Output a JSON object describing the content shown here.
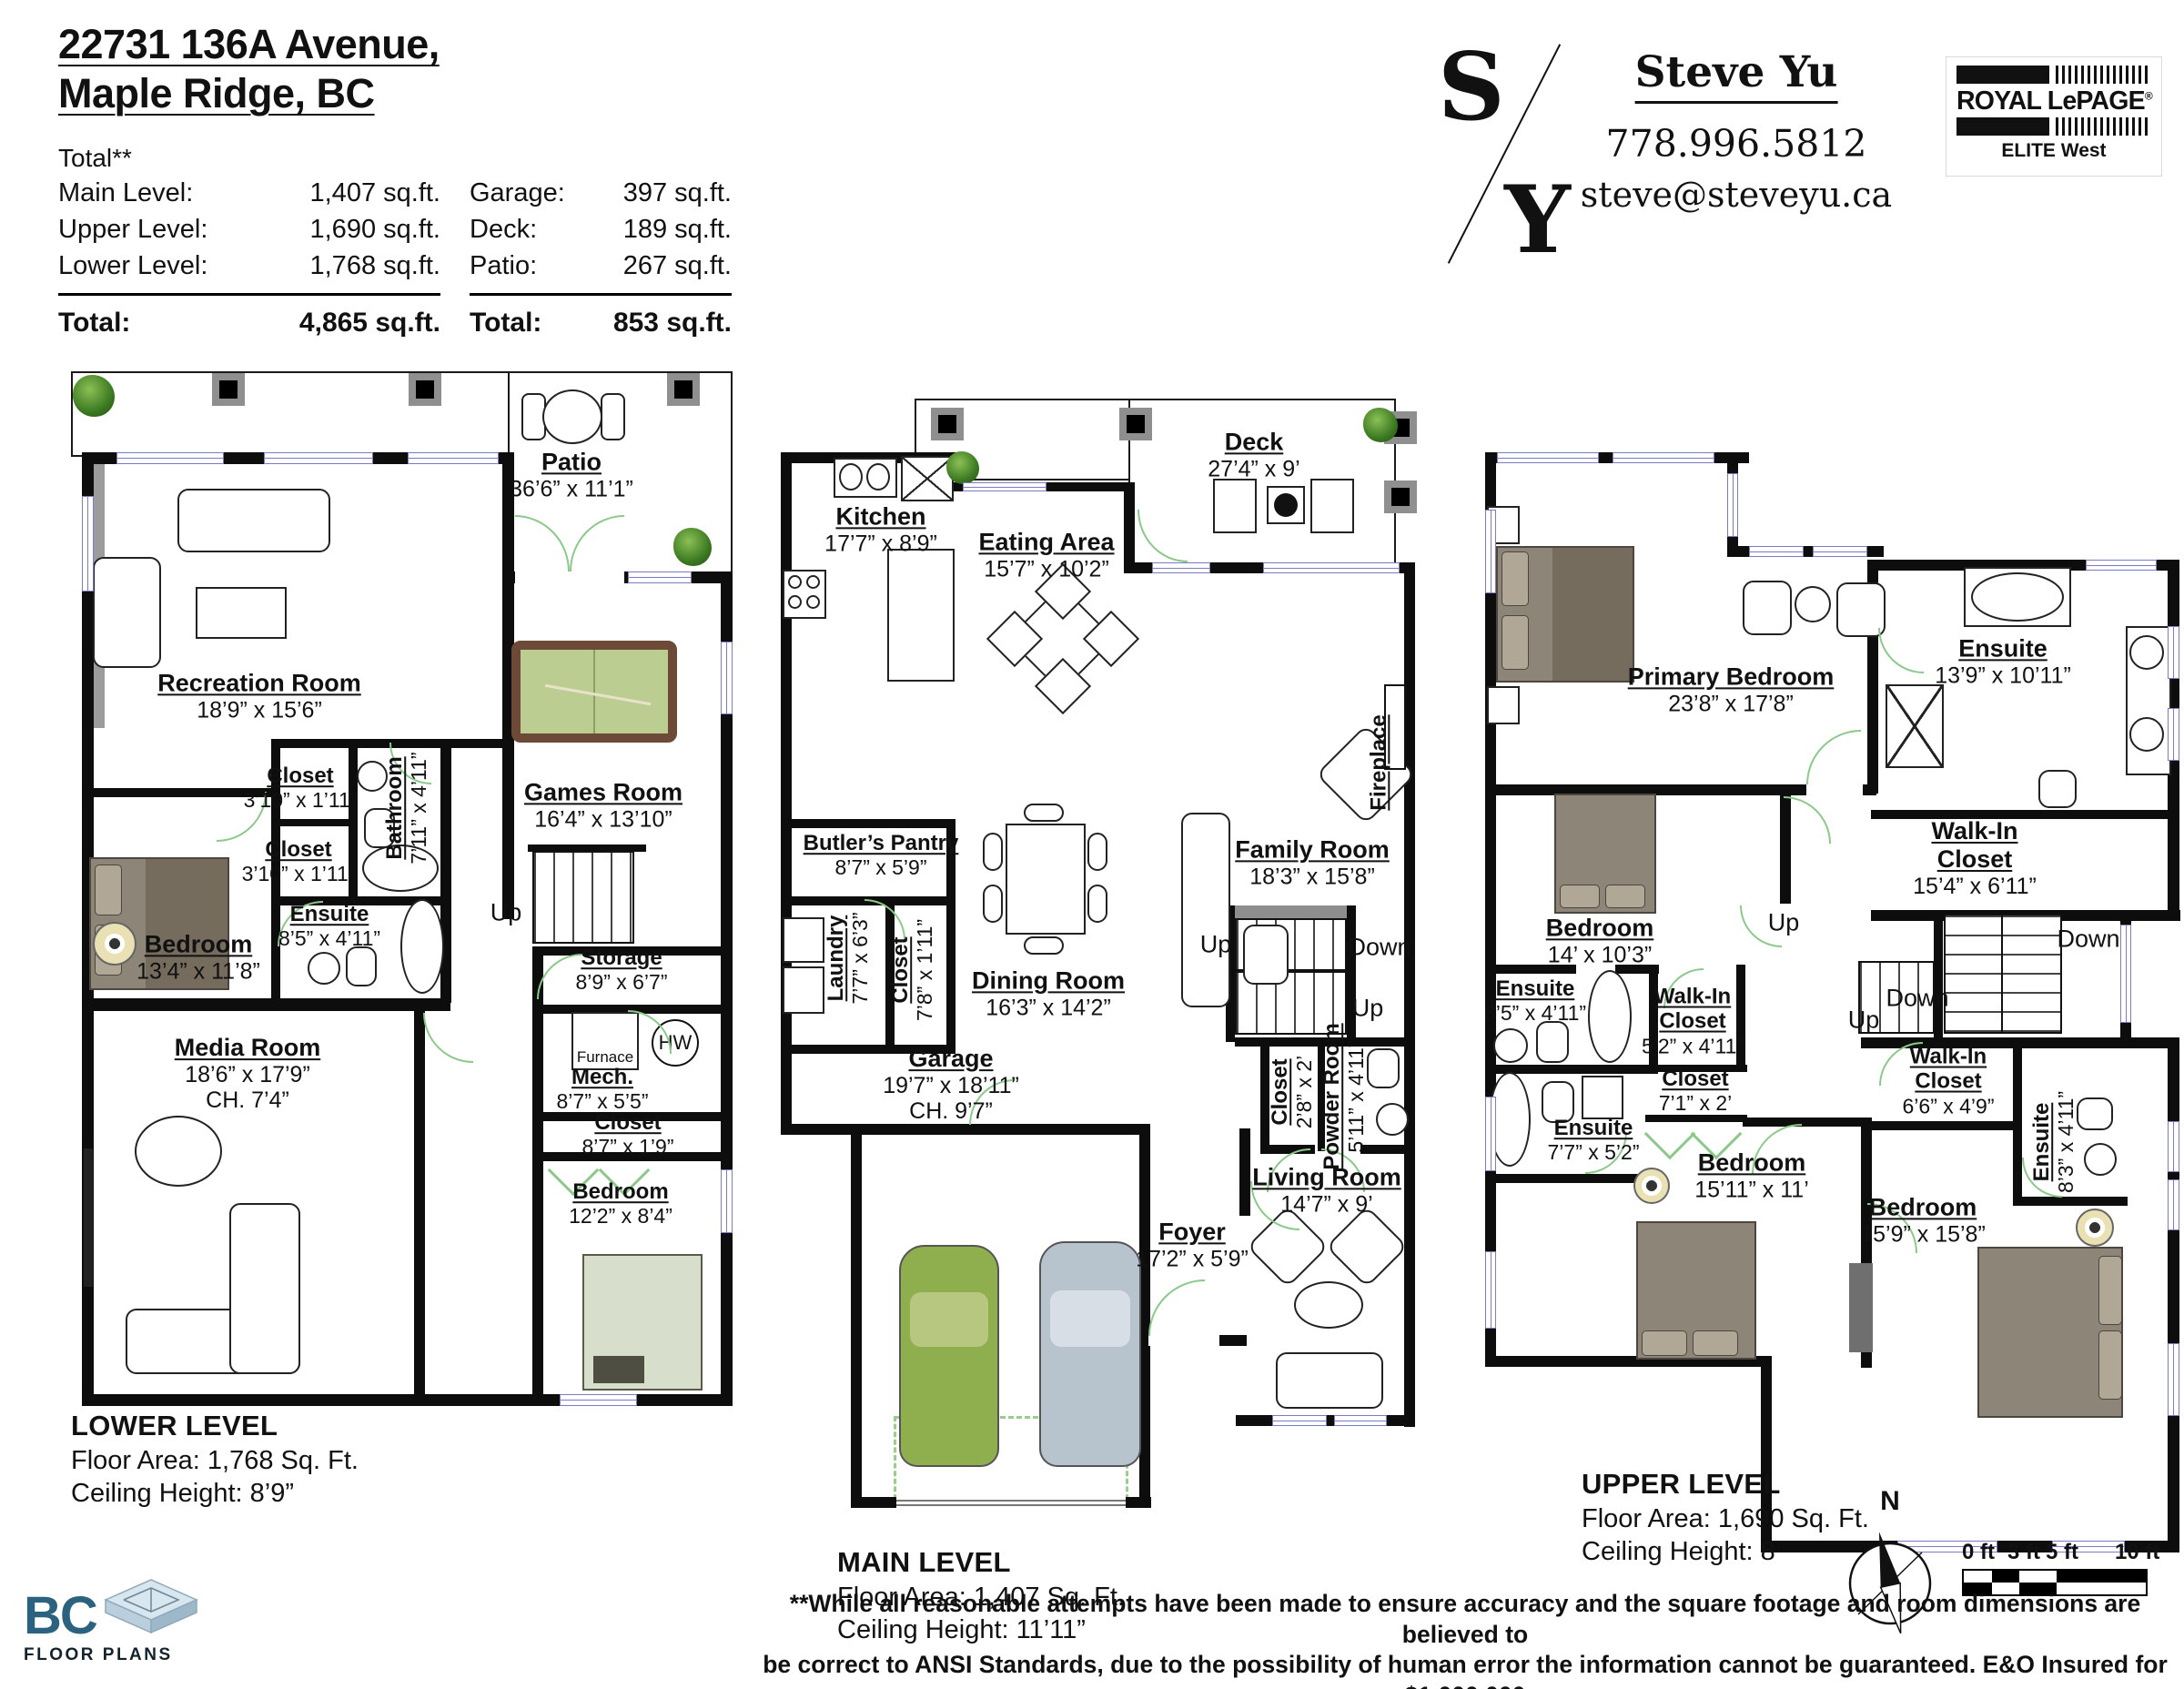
{
  "header": {
    "address_line1": "22731 136A Avenue,",
    "address_line2": "Maple Ridge, BC",
    "total_note": "Total**",
    "area_table": {
      "rows": [
        {
          "label": "Main Level:",
          "value": "1,407 sq.ft."
        },
        {
          "label": "Upper Level:",
          "value": "1,690 sq.ft."
        },
        {
          "label": "Lower Level:",
          "value": "1,768 sq.ft."
        }
      ],
      "total_label": "Total:",
      "total_value": "4,865 sq.ft."
    },
    "aux_table": {
      "rows": [
        {
          "label": "Garage:",
          "value": "397 sq.ft."
        },
        {
          "label": "Deck:",
          "value": "189 sq.ft."
        },
        {
          "label": "Patio:",
          "value": "267 sq.ft."
        }
      ],
      "total_label": "Total:",
      "total_value": "853 sq.ft."
    },
    "agent": {
      "monogram_top": "S",
      "monogram_bottom": "Y",
      "name": "Steve Yu",
      "phone": "778.996.5812",
      "email": "steve@steveyu.ca"
    },
    "brokerage": {
      "name": "ROYAL LePAGE",
      "reg": "®",
      "office": "ELITE West"
    }
  },
  "levels": {
    "lower": {
      "title": "LOWER LEVEL",
      "floor_area": "Floor Area: 1,768 Sq. Ft.",
      "ceiling": "Ceiling Height: 8’9”",
      "stair_up": "Up",
      "furnace": "Furnace",
      "hot_water": "HW",
      "rooms": [
        {
          "name": "Patio",
          "dims": "36’6” x 11’1”"
        },
        {
          "name": "Recreation Room",
          "dims": "18’9” x 15’6”"
        },
        {
          "name": "Games Room",
          "dims": "16’4” x 13’10”"
        },
        {
          "name": "Closet",
          "dims": "3’10” x 1’11”"
        },
        {
          "name": "Closet",
          "dims": "3’10” x 1’11”"
        },
        {
          "name": "Bathroom",
          "dims": "7’11” x 4’11”"
        },
        {
          "name": "Ensuite",
          "dims": "8’5” x 4’11”"
        },
        {
          "name": "Bedroom",
          "dims": "13’4” x 11’8”"
        },
        {
          "name": "Storage",
          "dims": "8’9” x 6’7”"
        },
        {
          "name": "Mech.",
          "dims": "8’7” x 5’5”"
        },
        {
          "name": "Closet",
          "dims": "8’7” x 1’9”"
        },
        {
          "name": "Bedroom",
          "dims": "12’2” x 8’4”"
        },
        {
          "name": "Media Room",
          "dims": "18’6” x 17’9”",
          "extra": "CH. 7’4”"
        }
      ]
    },
    "main": {
      "title": "MAIN LEVEL",
      "floor_area": "Floor Area: 1,407 Sq. Ft.",
      "ceiling": "Ceiling Height: 11’11”",
      "up": "Up",
      "down": "Down",
      "rooms": [
        {
          "name": "Deck",
          "dims": "27’4” x 9’"
        },
        {
          "name": "Kitchen",
          "dims": "17’7” x 8’9”"
        },
        {
          "name": "Eating Area",
          "dims": "15’7” x 10’2”"
        },
        {
          "name": "Butler’s Pantry",
          "dims": "8’7” x 5’9”"
        },
        {
          "name": "Laundry",
          "dims": "7’7” x 6’3”"
        },
        {
          "name": "Closet",
          "dims": "7’8” x 1’11”"
        },
        {
          "name": "Dining Room",
          "dims": "16’3” x 14’2”"
        },
        {
          "name": "Family Room",
          "dims": "18’3” x 15’8”"
        },
        {
          "name": "Fireplace",
          "dims": ""
        },
        {
          "name": "Garage",
          "dims": "19’7” x 18’11”",
          "extra": "CH. 9’7”"
        },
        {
          "name": "Closet",
          "dims": "2’8” x 2’"
        },
        {
          "name": "Powder Room",
          "dims": "5’11” x 4’11”"
        },
        {
          "name": "Living Room",
          "dims": "14’7” x 9’"
        },
        {
          "name": "Foyer",
          "dims": "17’2” x 5’9”"
        }
      ]
    },
    "upper": {
      "title": "UPPER LEVEL",
      "floor_area": "Floor Area: 1,690 Sq. Ft.",
      "ceiling": "Ceiling Height: 8’",
      "up": "Up",
      "down": "Down",
      "rooms": [
        {
          "name": "Primary Bedroom",
          "dims": "23’8” x 17’8”"
        },
        {
          "name": "Ensuite",
          "dims": "13’9” x 10’11”"
        },
        {
          "name": "Walk-In Closet",
          "dims": "15’4” x 6’11”"
        },
        {
          "name": "Bedroom",
          "dims": "14’ x 10’3”"
        },
        {
          "name": "Ensuite",
          "dims": "8’5” x 4’11”"
        },
        {
          "name": "Walk-In Closet",
          "dims": "5’2” x 4’11”"
        },
        {
          "name": "Closet",
          "dims": "7’1” x 2’"
        },
        {
          "name": "Ensuite",
          "dims": "7’7” x 5’2”"
        },
        {
          "name": "Bedroom",
          "dims": "15’11” x 11’"
        },
        {
          "name": "Walk-In Closet",
          "dims": "6’6” x 4’9”"
        },
        {
          "name": "Ensuite",
          "dims": "8’3” x 4’11”"
        },
        {
          "name": "Bedroom",
          "dims": "15’9” x 15’8”"
        }
      ]
    }
  },
  "footer": {
    "disclaimer_line1": "**While all reasonable attempts have been made to ensure accuracy and the square footage and room dimensions are believed to",
    "disclaimer_line2": "be correct to ANSI Standards, due to the possibility of human error the information cannot be guaranteed. E&O Insured for $1,000,000",
    "disclaimer_line3": "** May Include Unfinished areas",
    "compass_label": "N",
    "scale_labels": [
      "0 ft",
      "3 ft",
      "5 ft",
      "10 ft"
    ],
    "logo": {
      "bc": "BC",
      "floor_plans": "FLOOR PLANS"
    }
  },
  "colors": {
    "door_accent": "#8bc98b",
    "window_line": "#7c7cc4",
    "pool_felt": "#bccd92",
    "car_green": "#8fae4e",
    "car_grey": "#b7c3cd"
  }
}
